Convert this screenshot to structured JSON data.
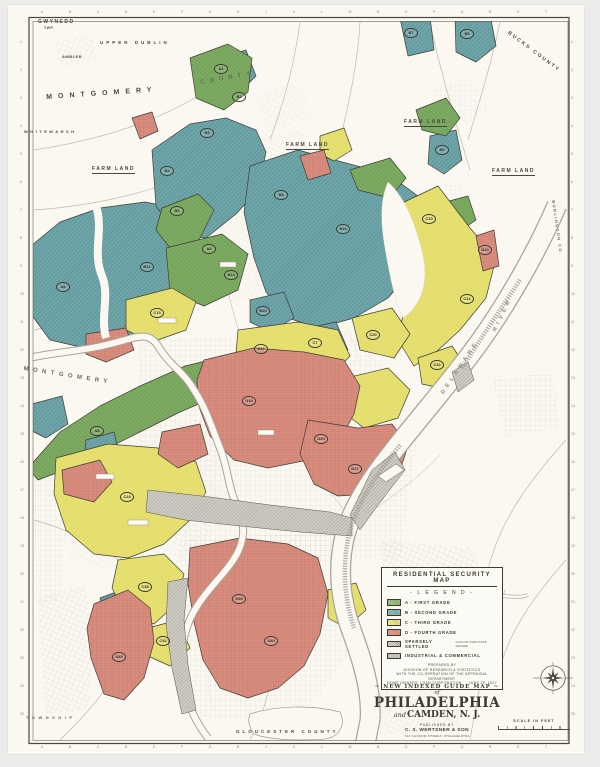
{
  "colors": {
    "paper": "#faf8f1",
    "ink": "#3f3e36",
    "grade_a": "#7dab62",
    "grade_b": "#6fa6a9",
    "grade_c": "#e6e170",
    "grade_d": "#d98e7f",
    "industrial": "#cfccc4",
    "river_bank": "#a8a49a",
    "street": "#b4b0a5",
    "legend_a": "#9dc47e",
    "legend_b": "#8fbab6",
    "legend_c": "#efec8c",
    "legend_d": "#e89c8c",
    "legend_sparse": "#dad8d0",
    "legend_industrial": "#d4d2ca"
  },
  "legend": {
    "title": "RESIDENTIAL SECURITY MAP",
    "subtitle": "- L E G E N D -",
    "items": [
      {
        "label": "A - FIRST GRADE",
        "color_key": "legend_a",
        "hatch": "diag"
      },
      {
        "label": "B - SECOND GRADE",
        "color_key": "legend_b",
        "hatch": "diag"
      },
      {
        "label": "C - THIRD GRADE",
        "color_key": "legend_c",
        "hatch": "diag"
      },
      {
        "label": "D - FOURTH GRADE",
        "color_key": "legend_d",
        "hatch": "diag"
      },
      {
        "label": "SPARSELY SETTLED",
        "note": "(COLOR INDICATES GRADE)",
        "color_key": "legend_sparse",
        "hatch": "diag-dark"
      },
      {
        "label": "INDUSTRIAL & COMMERCIAL",
        "color_key": "legend_industrial",
        "hatch": "fine"
      }
    ],
    "prepared": [
      "PREPARED BY",
      "DIVISION OF RESEARCH & STATISTICS",
      "WITH THE CO-OPERATION OF THE APPRAISAL DEPARTMENT"
    ],
    "corporation": "HOME OWNERS' LOAN CORPORATION",
    "date": "JUNE 29, 1937"
  },
  "title_block": {
    "kicker": "NEW INDEXED GUIDE MAP",
    "of_word": "of",
    "city": "PHILADELPHIA",
    "and_word": "and",
    "city2": "CAMDEN, N. J.",
    "published_by": "PUBLISHED BY",
    "publisher": "C. S. WERTSNER & SON",
    "address": "744 SANSOM STREET, PHILADELPHIA"
  },
  "scale_bar": {
    "label": "SCALE IN FEET"
  },
  "map": {
    "region_labels": [
      {
        "text": "GWYNEDD",
        "x": 38,
        "y": 19,
        "size": 5,
        "ls": 1.5
      },
      {
        "text": "TWP.",
        "x": 44,
        "y": 26,
        "size": 3.5,
        "ls": 0.5
      },
      {
        "text": "AMBLER",
        "x": 62,
        "y": 54,
        "size": 4,
        "ls": 0.5
      },
      {
        "text": "UPPER DUBLIN",
        "x": 100,
        "y": 40,
        "size": 4.5,
        "ls": 3
      },
      {
        "text": "MONTGOMERY",
        "x": 46,
        "y": 94,
        "size": 7,
        "ls": 6,
        "rot": -4
      },
      {
        "text": "COUNTY",
        "x": 200,
        "y": 80,
        "size": 6,
        "ls": 5,
        "rot": -10,
        "c": "#6a675c"
      },
      {
        "text": "WHITEMARSH",
        "x": 24,
        "y": 129,
        "size": 4,
        "ls": 2.5
      },
      {
        "text": "MONTGOMERY",
        "x": 24,
        "y": 366,
        "size": 6,
        "ls": 4.5,
        "rot": 9,
        "c": "#6a675c"
      },
      {
        "text": "FARM LAND",
        "x": 92,
        "y": 166,
        "size": 5,
        "ls": 1.5,
        "u": true
      },
      {
        "text": "FARM LAND",
        "x": 286,
        "y": 142,
        "size": 5,
        "ls": 1.5,
        "u": true
      },
      {
        "text": "FARM LAND",
        "x": 404,
        "y": 119,
        "size": 5,
        "ls": 1.5,
        "u": true
      },
      {
        "text": "FARM LAND",
        "x": 492,
        "y": 168,
        "size": 5,
        "ls": 1.5,
        "u": true
      },
      {
        "text": "BUCKS COUNTY",
        "x": 510,
        "y": 30,
        "size": 5,
        "ls": 2,
        "rot": 37
      },
      {
        "text": "BURLINGTON CO.",
        "x": 556,
        "y": 200,
        "size": 4,
        "ls": 1.5,
        "rot": 82,
        "c": "#6a675c"
      },
      {
        "text": "DELAWARE",
        "x": 440,
        "y": 392,
        "size": 5.5,
        "ls": 4,
        "rot": -56,
        "c": "#8d8a7f"
      },
      {
        "text": "RIVER",
        "x": 492,
        "y": 330,
        "size": 5.5,
        "ls": 4,
        "rot": -64,
        "c": "#8d8a7f"
      },
      {
        "text": "GLOUCESTER COUNTY",
        "x": 236,
        "y": 729,
        "size": 4.5,
        "ls": 3
      },
      {
        "text": "TOWNSHIP",
        "x": 26,
        "y": 715,
        "size": 4,
        "ls": 3.5,
        "c": "#6a675c"
      }
    ],
    "zone_labels": [
      {
        "t": "B7",
        "x": 410,
        "y": 32
      },
      {
        "t": "B5",
        "x": 466,
        "y": 33
      },
      {
        "t": "A1",
        "x": 220,
        "y": 68
      },
      {
        "t": "B2",
        "x": 238,
        "y": 96
      },
      {
        "t": "B3",
        "x": 206,
        "y": 132
      },
      {
        "t": "B4",
        "x": 166,
        "y": 170
      },
      {
        "t": "B6",
        "x": 176,
        "y": 210
      },
      {
        "t": "A4",
        "x": 208,
        "y": 248
      },
      {
        "t": "B8",
        "x": 280,
        "y": 194
      },
      {
        "t": "B9",
        "x": 441,
        "y": 149
      },
      {
        "t": "B12",
        "x": 146,
        "y": 266
      },
      {
        "t": "A6",
        "x": 62,
        "y": 286
      },
      {
        "t": "B14",
        "x": 230,
        "y": 274
      },
      {
        "t": "B16",
        "x": 342,
        "y": 228
      },
      {
        "t": "C10",
        "x": 428,
        "y": 218
      },
      {
        "t": "C12",
        "x": 466,
        "y": 298
      },
      {
        "t": "D24",
        "x": 484,
        "y": 249
      },
      {
        "t": "B20",
        "x": 262,
        "y": 310
      },
      {
        "t": "C7",
        "x": 314,
        "y": 342
      },
      {
        "t": "C15",
        "x": 156,
        "y": 312
      },
      {
        "t": "C17",
        "x": 260,
        "y": 348
      },
      {
        "t": "C20",
        "x": 372,
        "y": 334
      },
      {
        "t": "C32",
        "x": 436,
        "y": 364
      },
      {
        "t": "D18",
        "x": 248,
        "y": 400
      },
      {
        "t": "D20",
        "x": 320,
        "y": 438
      },
      {
        "t": "D27",
        "x": 354,
        "y": 468
      },
      {
        "t": "A8",
        "x": 96,
        "y": 430
      },
      {
        "t": "C24",
        "x": 126,
        "y": 496
      },
      {
        "t": "D35",
        "x": 238,
        "y": 598
      },
      {
        "t": "D40",
        "x": 270,
        "y": 640
      },
      {
        "t": "C38",
        "x": 144,
        "y": 586
      },
      {
        "t": "C42",
        "x": 162,
        "y": 640
      },
      {
        "t": "D45",
        "x": 118,
        "y": 656
      }
    ],
    "grid": {
      "letters": [
        "A",
        "B",
        "C",
        "D",
        "E",
        "F",
        "G",
        "H",
        "J",
        "K",
        "L",
        "M",
        "N",
        "O",
        "P",
        "Q",
        "R",
        "S",
        "T"
      ],
      "numbers": [
        "1",
        "2",
        "3",
        "4",
        "5",
        "6",
        "7",
        "8",
        "9",
        "10",
        "11",
        "12",
        "13",
        "14",
        "15",
        "16",
        "17",
        "18",
        "19",
        "20",
        "21",
        "22",
        "23",
        "24",
        "25"
      ]
    }
  }
}
